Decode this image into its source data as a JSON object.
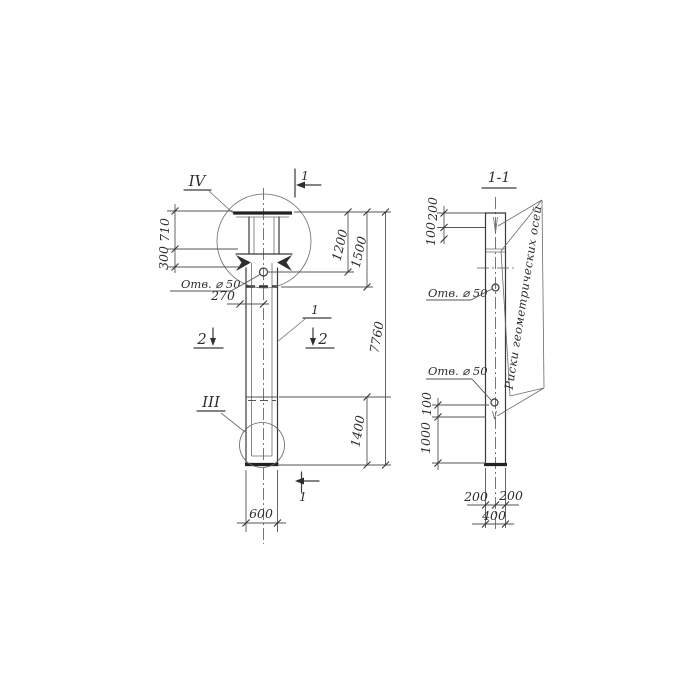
{
  "left_view": {
    "detail_marker_top": "IV",
    "detail_marker_bottom": "III",
    "part_callout": "1",
    "hole_label": "Отв. ⌀ 50",
    "dims": {
      "plate_width": "710",
      "corbel": "300",
      "hole_offset": "270",
      "top_to_hole": "1200",
      "top_to_joint": "1500",
      "total": "7760",
      "bottom_segment": "1400",
      "width": "600"
    }
  },
  "sections": {
    "mark_1": "1",
    "mark_2": "2"
  },
  "section_view": {
    "title": "1-1",
    "hole_label_upper": "Отв. ⌀ 50",
    "hole_label_lower": "Отв. ⌀ 50",
    "axes_note": "Риски геометрических осей",
    "dims": {
      "top": "200",
      "top2": "100",
      "lower": "100",
      "lower2": "1000",
      "half_left": "200",
      "half_right": "200",
      "width": "400"
    }
  }
}
